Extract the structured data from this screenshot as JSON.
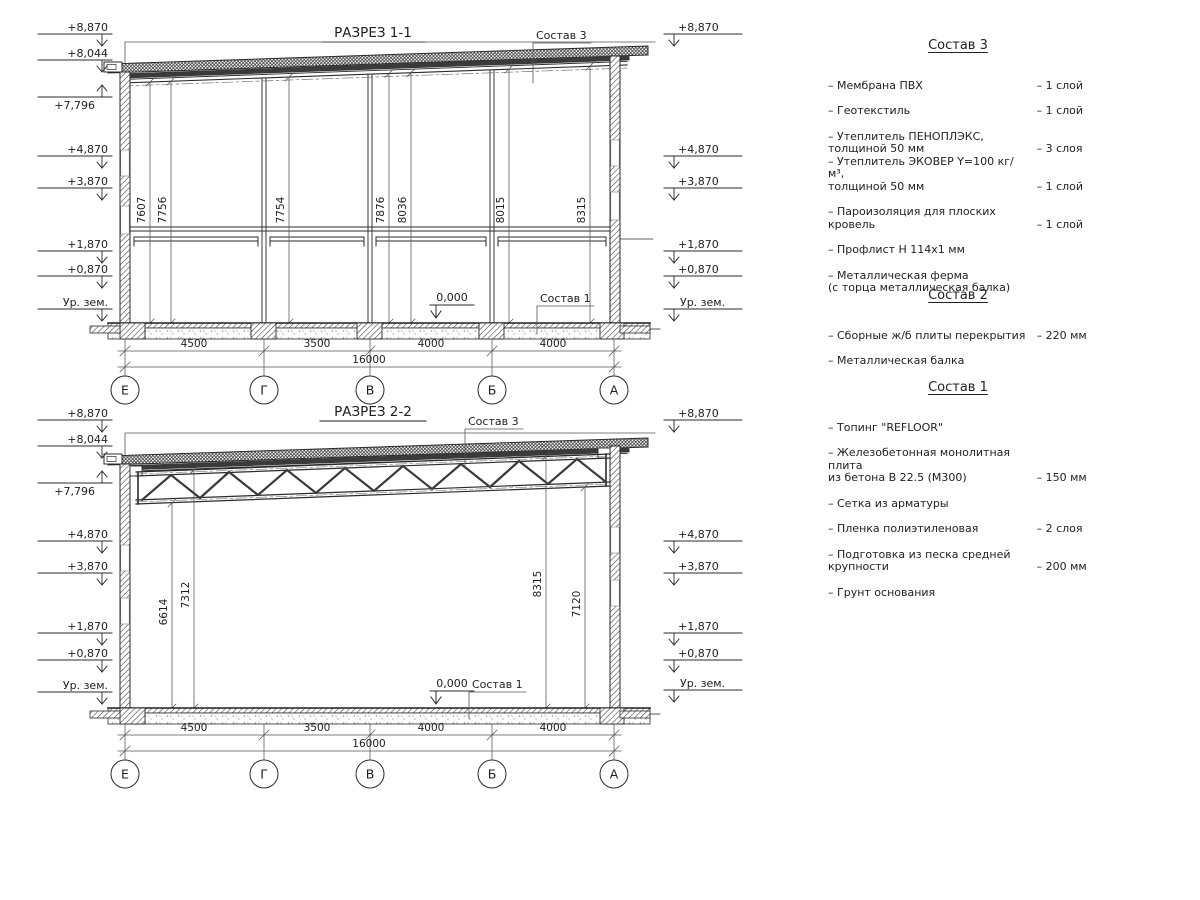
{
  "colors": {
    "line": "#2b2b2b",
    "background": "#ffffff"
  },
  "drawing": {
    "labels": {
      "zero_level": "0,000",
      "roof_ref": "Состав 3",
      "floor_ref": "Состав 1"
    },
    "levels_left": [
      "+8,870",
      "+8,044",
      "+7,796",
      "+4,870",
      "+3,870",
      "+1,870",
      "+0,870",
      "Ур. зем."
    ],
    "levels_right": [
      "+8,870",
      "+4,870",
      "+3,870",
      "+1,870",
      "+0,870",
      "Ур. зем."
    ],
    "axes": [
      "Е",
      "Г",
      "В",
      "Б",
      "А"
    ],
    "span_dims": [
      "4500",
      "3500",
      "4000",
      "4000"
    ],
    "total_dim": "16000",
    "section1": {
      "title": "РАЗРЕЗ 1-1",
      "vertical_dims": [
        "7607",
        "7756",
        "7754",
        "7876",
        "8036",
        "8015",
        "8315"
      ]
    },
    "section2": {
      "title": "РАЗРЕЗ 2-2",
      "vertical_dims": [
        "6614",
        "7312",
        "8315",
        "7120"
      ]
    }
  },
  "legend": {
    "sections": [
      {
        "title": "Состав 3",
        "items": [
          {
            "name": "– Мембрана ПВХ",
            "qty": "– 1 слой"
          },
          {
            "name": "– Геотекстиль",
            "qty": "– 1 слой"
          },
          {
            "name": "– Утеплитель ПЕНОПЛЭКС,\nтолщиной 50 мм",
            "qty": "– 3 слоя"
          },
          {
            "name": "– Утеплитель ЭКОВЕР Y=100 кг/м³,\nтолщиной 50 мм",
            "qty": "– 1 слой"
          },
          {
            "name": "– Пароизоляция для плоских кровель",
            "qty": "– 1 слой"
          },
          {
            "name": "– Профлист Н 114х1 мм",
            "qty": ""
          },
          {
            "name": "– Металлическая ферма\n(с торца металлическая балка)",
            "qty": ""
          }
        ]
      },
      {
        "title": "Состав 2",
        "items": [
          {
            "name": "– Сборные ж/б плиты перекрытия",
            "qty": "– 220 мм"
          },
          {
            "name": "– Металлическая балка",
            "qty": ""
          }
        ]
      },
      {
        "title": "Состав 1",
        "items": [
          {
            "name": "– Топинг \"REFLOOR\"",
            "qty": ""
          },
          {
            "name": "– Железобетонная  монолитная плита\nиз бетона В 22.5 (М300)",
            "qty": "– 150 мм"
          },
          {
            "name": "– Сетка из арматуры",
            "qty": ""
          },
          {
            "name": "– Пленка полиэтиленовая",
            "qty": "– 2 слоя"
          },
          {
            "name": "– Подготовка из песка средней\nкрупности",
            "qty": "– 200 мм"
          },
          {
            "name": "– Грунт основания",
            "qty": ""
          }
        ]
      }
    ]
  }
}
